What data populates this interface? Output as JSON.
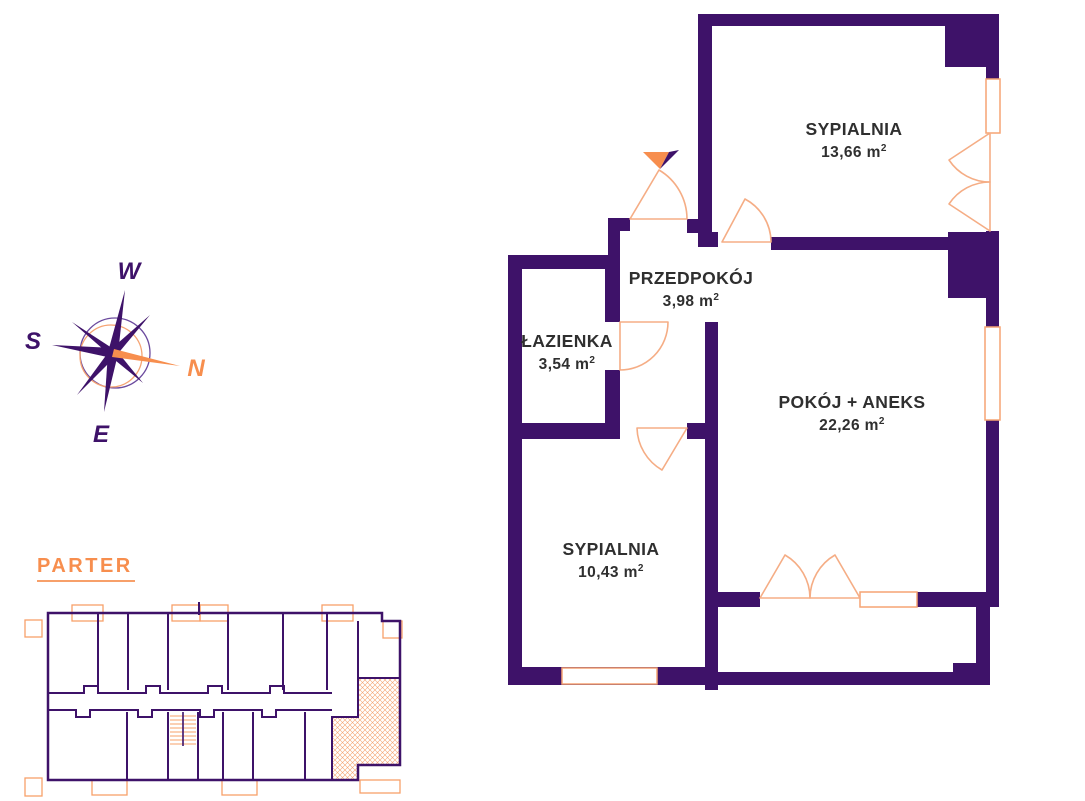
{
  "page": {
    "kind": "apartment floor plan drawing",
    "background": "#ffffff"
  },
  "overview": {
    "floor_label": "PARTER"
  },
  "compass": {
    "west": "W",
    "south": "S",
    "north": "N",
    "east": "E"
  },
  "rooms": [
    {
      "name": "SYPIALNIA",
      "area_text": "13,66 m",
      "area_sup": "2"
    },
    {
      "name": "PRZEDPOKÓJ",
      "area_text": "3,98 m",
      "area_sup": "2"
    },
    {
      "name": "ŁAZIENKA",
      "area_text": "3,54 m",
      "area_sup": "2"
    },
    {
      "name": "POKÓJ + ANEKS",
      "area_text": "22,26 m",
      "area_sup": "2"
    },
    {
      "name": "SYPIALNIA",
      "area_text": "10,43 m",
      "area_sup": "2"
    }
  ],
  "icons": {
    "compass_rose": "8-point-star-compass",
    "entrance_marker": "two-tone-pennant-triangle"
  },
  "colors": {
    "wall_purple": "#3E1269",
    "accent_orange": "#F78E4E",
    "light_orange": "#F5AD85",
    "window_orange": "#F5A473",
    "label_text": "#2F2F2F"
  }
}
